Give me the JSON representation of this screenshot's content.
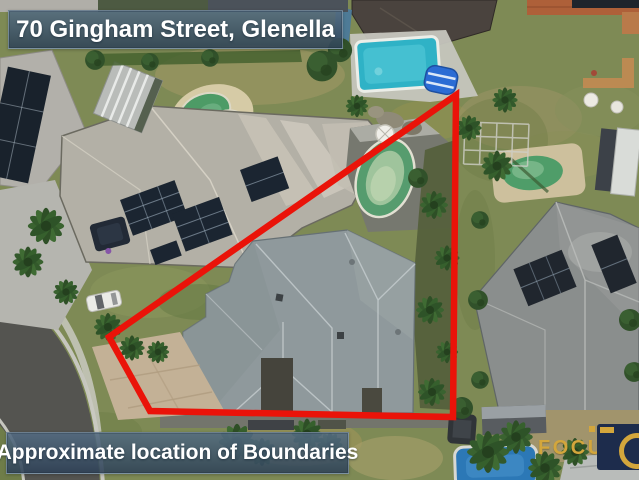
{
  "address_banner": {
    "text": "70 Gingham Street, Glenella"
  },
  "boundary_banner": {
    "text": "Approximate location of Boundaries"
  },
  "boundary": {
    "color": "#ea1309",
    "stroke_width": "6.5",
    "points": "456,95 109,337 150,411 453,417"
  },
  "watermark": {
    "brand_text": "FOCUS",
    "gold": "#d3a63c",
    "navy": "#1d2c4c"
  },
  "scene": {
    "type": "aerial-drone-photograph",
    "palette": {
      "grass": "#7e8a55",
      "dry_grass": "#a59a68",
      "road_asphalt": "#545450",
      "kerb_concrete": "#c6c6be",
      "subject_roof": "#8f999c",
      "left_roof": "#b3b0a6",
      "right_roof": "#8a8e8d",
      "dark_roof": "#4a433e",
      "terracotta_roof": "#ae6039",
      "solar_panel": "#1b2531",
      "pool_cyan": "#2fb2c6",
      "pool_green": "#569c6e",
      "pool_blue": "#2c78b6",
      "paver_driveway": "#c3b196",
      "palm_foliage": "#2e4f26"
    }
  }
}
